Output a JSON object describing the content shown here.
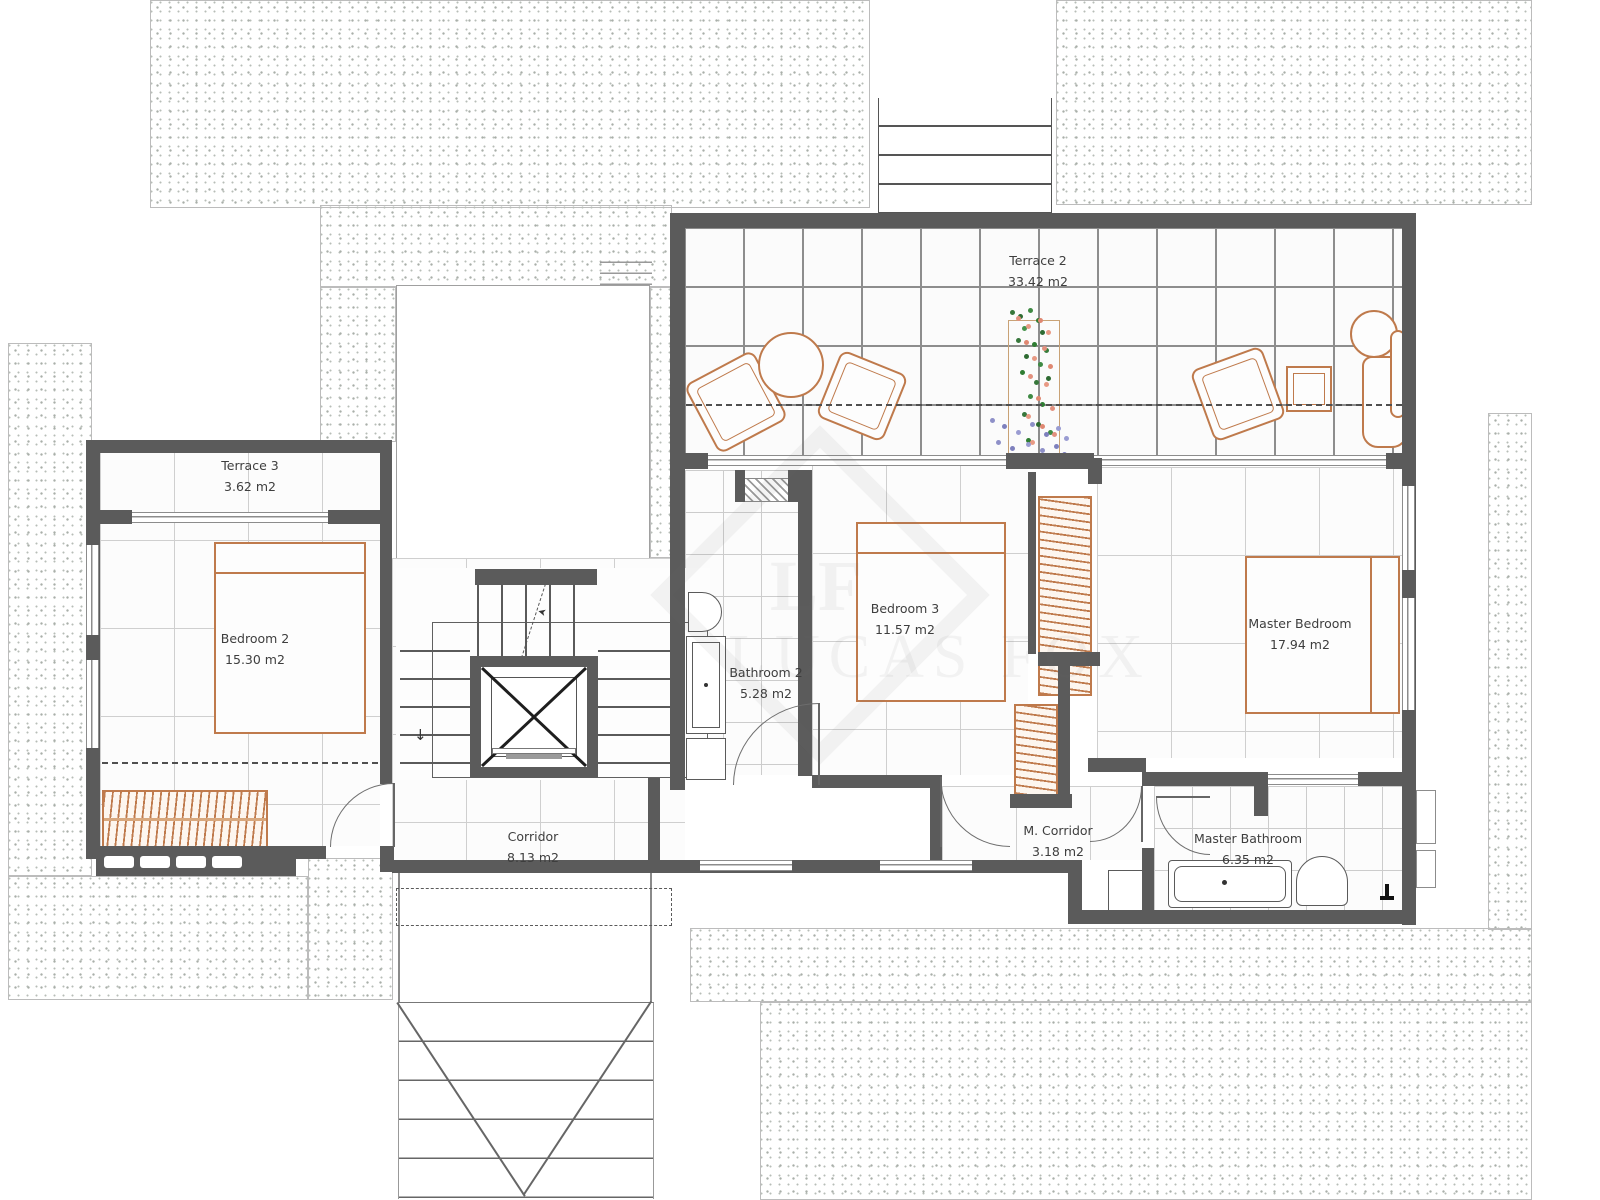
{
  "plan": {
    "title": "First floor plan",
    "rooms": [
      {
        "name": "Terrace 2",
        "area": "33.42 m2"
      },
      {
        "name": "Terrace 3",
        "area": "3.62 m2"
      },
      {
        "name": "Bedroom 2",
        "area": "15.30 m2"
      },
      {
        "name": "Bedroom 3",
        "area": "11.57 m2"
      },
      {
        "name": "Master Bedroom",
        "area": "17.94 m2"
      },
      {
        "name": "Bathroom 2",
        "area": "5.28 m2"
      },
      {
        "name": "Corridor",
        "area": "8.13 m2"
      },
      {
        "name": "M. Corridor",
        "area": "3.18 m2"
      },
      {
        "name": "Master Bathroom",
        "area": "6.35 m2"
      }
    ],
    "watermark": {
      "monogram": "LF",
      "text": "LUCAS FOX"
    },
    "stairs": {
      "down_arrow": "↓",
      "up_arrow": "➤"
    },
    "colors": {
      "wall": "#5b5b5b",
      "furniture": "#bf7a4c",
      "grid": "#cfcfcf",
      "terrace_grid": "#8d8d8d"
    }
  }
}
